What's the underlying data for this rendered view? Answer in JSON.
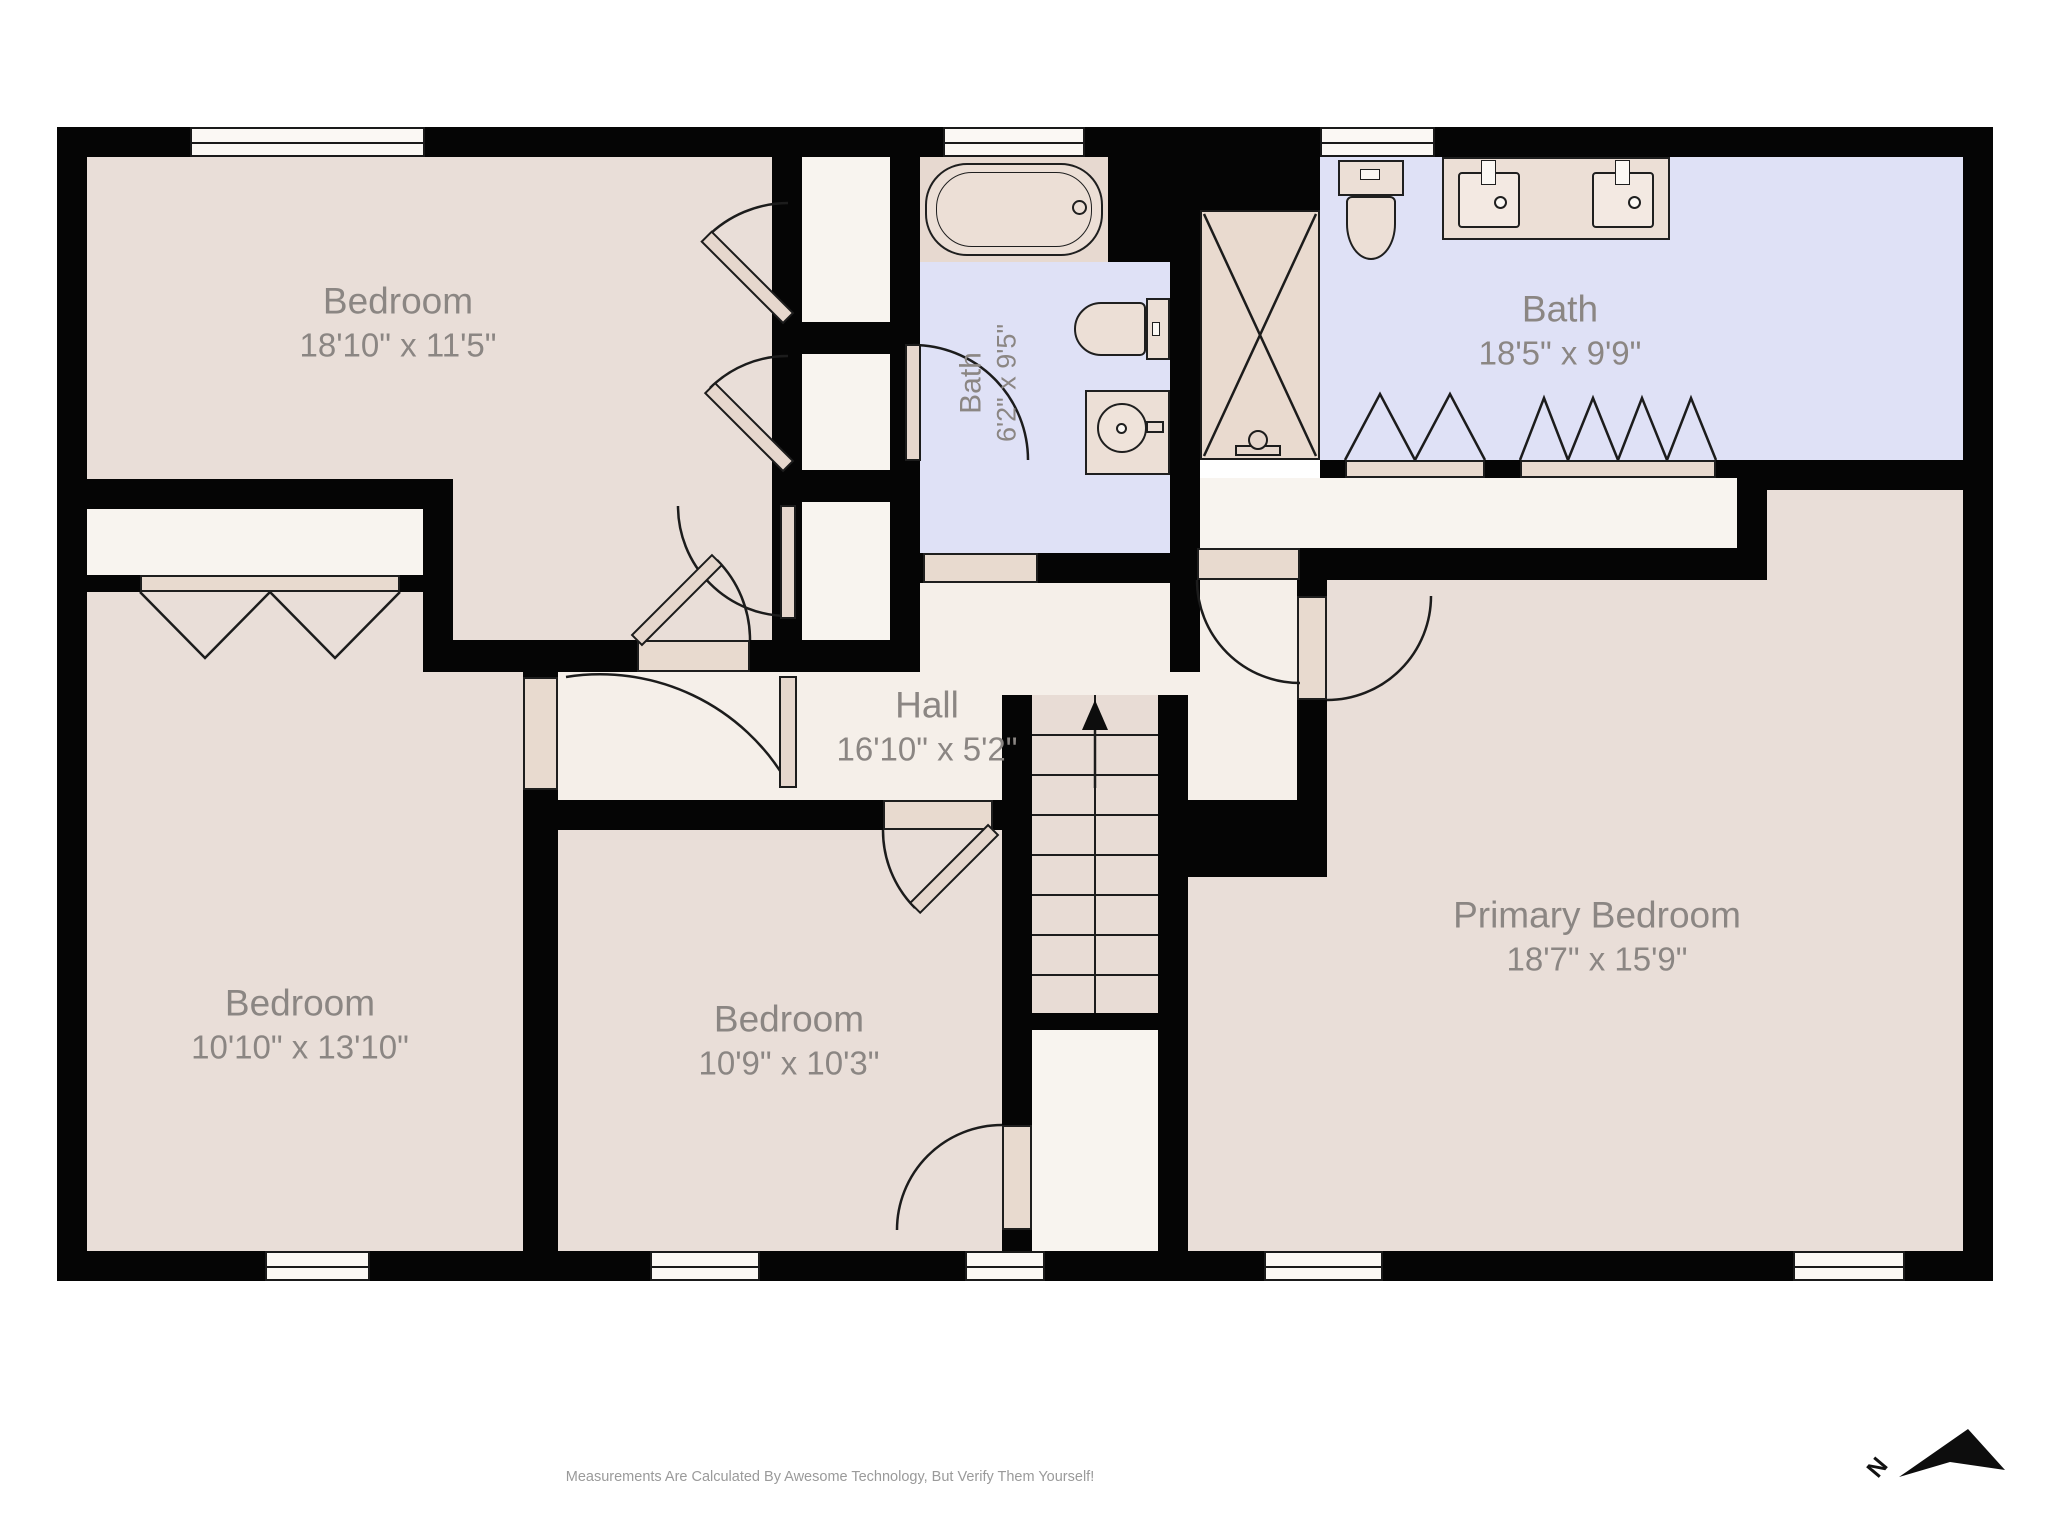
{
  "title": "Second Floor Plan",
  "footer": {
    "disclaimer": "Measurements Are Calculated By Awesome Technology, But Verify Them Yourself!"
  },
  "compass": {
    "label": "N",
    "direction": "northeast"
  },
  "rooms": [
    {
      "id": "bedroom-top-left",
      "name": "Bedroom",
      "dims": "18'10\" x 11'5\""
    },
    {
      "id": "bath-small",
      "name": "Bath",
      "dims": "6'2\" x 9'5\""
    },
    {
      "id": "bath-primary",
      "name": "Bath",
      "dims": "18'5\" x 9'9\""
    },
    {
      "id": "hall",
      "name": "Hall",
      "dims": "16'10\" x 5'2\""
    },
    {
      "id": "bedroom-bottom-left",
      "name": "Bedroom",
      "dims": "10'10\" x 13'10\""
    },
    {
      "id": "bedroom-center",
      "name": "Bedroom",
      "dims": "10'9\" x 10'3\""
    },
    {
      "id": "bedroom-primary",
      "name": "Primary Bedroom",
      "dims": "18'7\" x 15'9\""
    }
  ],
  "fixtures": [
    "bathtub",
    "toilet",
    "pedestal-sink-vanity",
    "shower-stall",
    "double-sink-vanity",
    "staircase-up",
    "bifold-closet-doors",
    "swing-doors",
    "windows"
  ],
  "colors": {
    "wall": "#050505",
    "bedroom_floor": "#e9ded8",
    "hall_floor": "#f5efe9",
    "closet_floor": "#f8f4ef",
    "bath_floor": "#dfe1f6",
    "fixture_fill": "#ecdfd6",
    "casing_fill": "#e8dacf",
    "label_text": "#8b8683",
    "footer_text": "#9a9a9a"
  }
}
